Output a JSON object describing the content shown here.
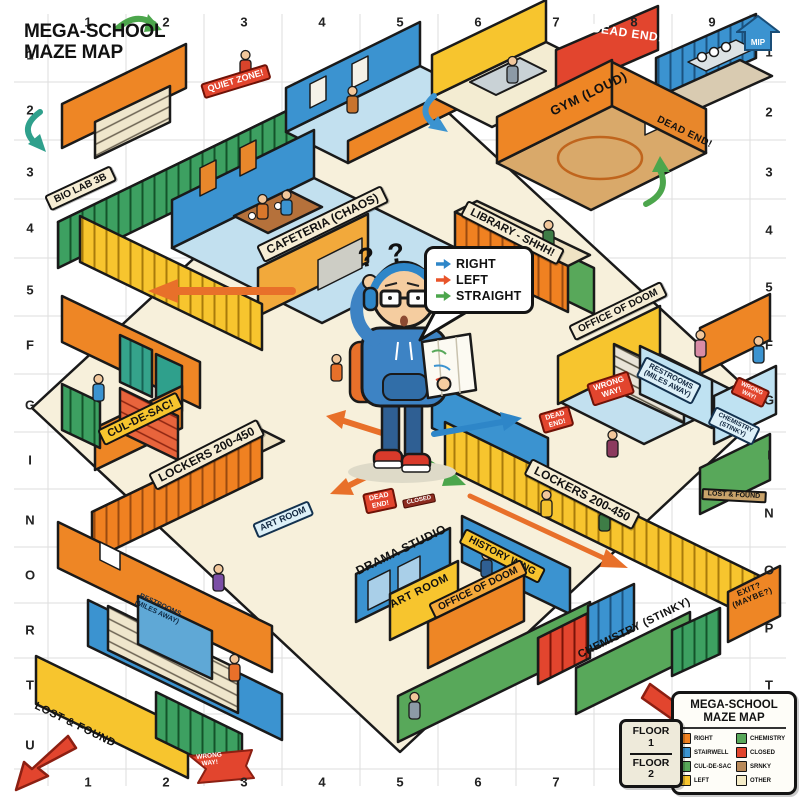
{
  "title": {
    "line1": "MEGA-SCHOOL",
    "line2": "MAZE MAP"
  },
  "compass": {
    "label": "MIP"
  },
  "grid": {
    "top": [
      "1",
      "2",
      "3",
      "4",
      "5",
      "6",
      "7",
      "8",
      "9"
    ],
    "bottom": [
      "1",
      "2",
      "3",
      "4",
      "5",
      "6",
      "7",
      "8",
      "9"
    ],
    "left": [
      "1",
      "2",
      "3",
      "4",
      "5",
      "F",
      "G",
      "I",
      "N",
      "O",
      "R",
      "T",
      "U"
    ],
    "right": [
      "1",
      "2",
      "3",
      "4",
      "5",
      "F",
      "G",
      "I",
      "N",
      "O",
      "P",
      "T",
      "H"
    ]
  },
  "speech_bubble": {
    "items": [
      {
        "label": "RIGHT",
        "color": "#2E86C8"
      },
      {
        "label": "LEFT",
        "color": "#E8542A"
      },
      {
        "label": "STRAIGHT",
        "color": "#4CA64C"
      }
    ]
  },
  "character": {
    "thought": "? ?"
  },
  "rooms": [
    {
      "id": "bio-lab",
      "label": "BIO LAB 3B"
    },
    {
      "id": "quiet-zone",
      "label": "QUIET ZONE!"
    },
    {
      "id": "cafeteria",
      "label": "CAFETERIA (CHAOS)"
    },
    {
      "id": "gym",
      "label": "GYM (LOUD)"
    },
    {
      "id": "dead-end-top",
      "label": "DEAD END!"
    },
    {
      "id": "dead-end-gym",
      "label": "DEAD END!"
    },
    {
      "id": "library",
      "label": "LIBRARY - SHHH!"
    },
    {
      "id": "office-of-doom-upper",
      "label": "OFFICE OF DOOM"
    },
    {
      "id": "restrooms-right",
      "label": "RESTROOMS\n(MILES AWAY)"
    },
    {
      "id": "wrong-way-center",
      "label": "WRONG\nWAY!"
    },
    {
      "id": "wrong-way-right",
      "label": "WRONG\nWAY!"
    },
    {
      "id": "chemistry-right",
      "label": "CHEMISTRY\n(STINKY)"
    },
    {
      "id": "dead-end-center",
      "label": "DEAD\nEND!"
    },
    {
      "id": "dead-end-lower",
      "label": "DEAD\nEND!"
    },
    {
      "id": "closed-sign",
      "label": "CLOSED"
    },
    {
      "id": "cul-de-sac",
      "label": "CUL-DE-SAC!"
    },
    {
      "id": "lockers-left",
      "label": "LOCKERS 200-450"
    },
    {
      "id": "lockers-right",
      "label": "LOCKERS 200-450"
    },
    {
      "id": "art-room-left",
      "label": "ART ROOM"
    },
    {
      "id": "history-wing",
      "label": "HISTORY WING"
    },
    {
      "id": "drama-studio",
      "label": "DRAMA STUDIO"
    },
    {
      "id": "art-room-lower",
      "label": "ART ROOM"
    },
    {
      "id": "office-of-doom-lower",
      "label": "OFFICE OF DOOM"
    },
    {
      "id": "chemistry-lower",
      "label": "CHEMISTRY (STINKY)"
    },
    {
      "id": "exit",
      "label": "EXIT?\n(MAYBE?)"
    },
    {
      "id": "lost-and-found",
      "label": "LOST & FOUND"
    },
    {
      "id": "lost-and-found-right",
      "label": "LOST & FOUND"
    },
    {
      "id": "restrooms-left",
      "label": "RESTROOMS\n(MILES AWAY)"
    },
    {
      "id": "wrong-way-flag",
      "label": "WRONG\nWAY!"
    }
  ],
  "legend": {
    "title_line1": "MEGA-SCHOOL",
    "title_line2": "MAZE MAP",
    "left": [
      {
        "label": "RIGHT",
        "color": "#F08121"
      },
      {
        "label": "STAIRWELL",
        "color": "#3B93D0"
      },
      {
        "label": "CUL-DE-SAC",
        "color": "#58A85A"
      },
      {
        "label": "LEFT",
        "color": "#F7C52E"
      }
    ],
    "right": [
      {
        "label": "CHEMISTRY",
        "color": "#58A85A"
      },
      {
        "label": "CLOSED",
        "color": "#E2452E"
      },
      {
        "label": "SRNKY",
        "color": "#B98A5A"
      },
      {
        "label": "OTHER",
        "color": "#F5ECC8"
      }
    ]
  },
  "floors": {
    "upper": "FLOOR\n1",
    "lower": "FLOOR\n2"
  }
}
